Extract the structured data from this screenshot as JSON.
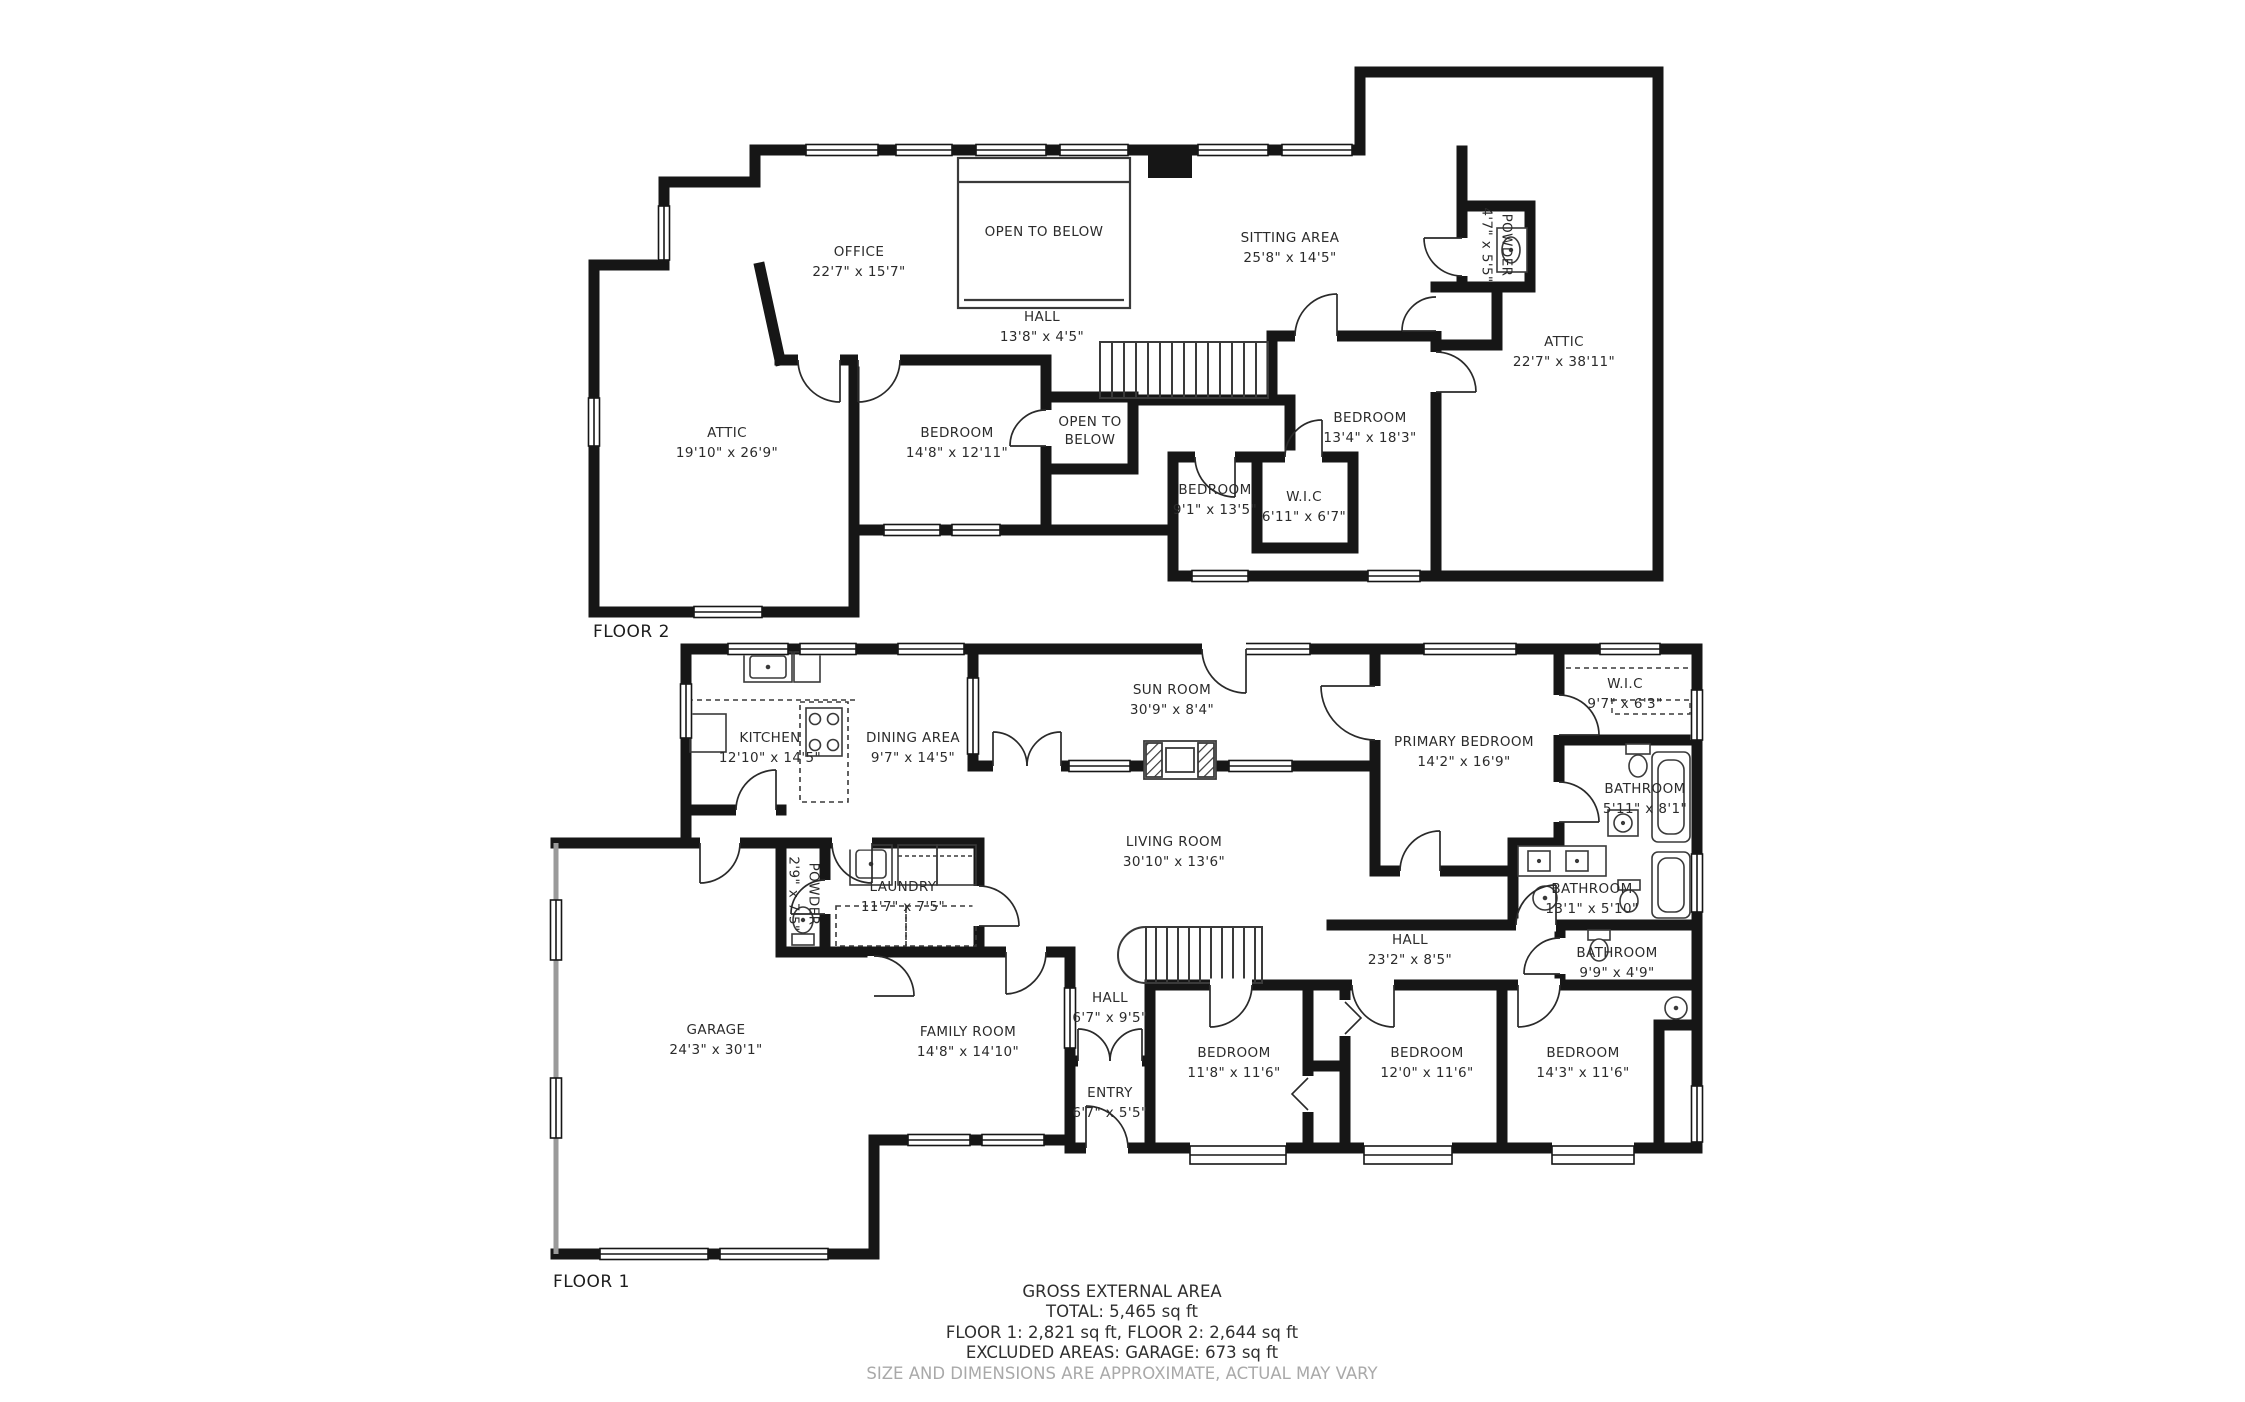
{
  "colors": {
    "wall": "#161616",
    "thin_line": "#3a3a3a",
    "gray_wall": "#9a9a9a",
    "text": "#2b2b2b",
    "muted_text": "#a9a9a9",
    "background": "#ffffff"
  },
  "floor2": {
    "label": "FLOOR 2",
    "rooms": [
      {
        "name": "OFFICE",
        "dims": "22'7\" x 15'7\""
      },
      {
        "name": "OPEN TO BELOW",
        "dims": ""
      },
      {
        "name": "SITTING AREA",
        "dims": "25'8\" x 14'5\""
      },
      {
        "name": "POWDER",
        "dims": "4'7\" x 5'5\""
      },
      {
        "name": "ATTIC",
        "dims": "22'7\" x 38'11\""
      },
      {
        "name": "HALL",
        "dims": "13'8\" x 4'5\""
      },
      {
        "name": "ATTIC",
        "dims": "19'10\" x 26'9\""
      },
      {
        "name": "BEDROOM",
        "dims": "14'8\" x 12'11\""
      },
      {
        "name": "OPEN TO BELOW",
        "dims": ""
      },
      {
        "name": "BEDROOM",
        "dims": "9'1\" x 13'5\""
      },
      {
        "name": "W.I.C",
        "dims": "6'11\" x 6'7\""
      },
      {
        "name": "BEDROOM",
        "dims": "13'4\" x 18'3\""
      }
    ]
  },
  "floor1": {
    "label": "FLOOR 1",
    "rooms": [
      {
        "name": "KITCHEN",
        "dims": "12'10\" x 14'5\""
      },
      {
        "name": "DINING AREA",
        "dims": "9'7\" x 14'5\""
      },
      {
        "name": "SUN ROOM",
        "dims": "30'9\" x 8'4\""
      },
      {
        "name": "W.I.C",
        "dims": "9'7\" x 6'3\""
      },
      {
        "name": "PRIMARY BEDROOM",
        "dims": "14'2\" x 16'9\""
      },
      {
        "name": "BATHROOM",
        "dims": "5'11\" x 8'1\""
      },
      {
        "name": "LIVING ROOM",
        "dims": "30'10\" x 13'6\""
      },
      {
        "name": "POWDER",
        "dims": "2'9\" x 7'5\""
      },
      {
        "name": "LAUNDRY",
        "dims": "11'7\" x 7'5\""
      },
      {
        "name": "BATHROOM",
        "dims": "13'1\" x 5'10\""
      },
      {
        "name": "HALL",
        "dims": "23'2\" x 8'5\""
      },
      {
        "name": "BATHROOM",
        "dims": "9'9\" x 4'9\""
      },
      {
        "name": "GARAGE",
        "dims": "24'3\" x 30'1\""
      },
      {
        "name": "FAMILY ROOM",
        "dims": "14'8\" x 14'10\""
      },
      {
        "name": "HALL",
        "dims": "6'7\" x 9'5\""
      },
      {
        "name": "BEDROOM",
        "dims": "11'8\" x 11'6\""
      },
      {
        "name": "BEDROOM",
        "dims": "12'0\" x 11'6\""
      },
      {
        "name": "BEDROOM",
        "dims": "14'3\" x 11'6\""
      },
      {
        "name": "ENTRY",
        "dims": "6'7\" x 5'5\""
      }
    ]
  },
  "footer": {
    "title": "GROSS EXTERNAL AREA",
    "total": "TOTAL: 5,465 sq ft",
    "floors": "FLOOR 1: 2,821 sq ft, FLOOR 2: 2,644 sq ft",
    "excluded": "EXCLUDED AREAS: GARAGE: 673 sq ft",
    "disclaimer": "SIZE AND DIMENSIONS ARE APPROXIMATE, ACTUAL MAY VARY"
  }
}
